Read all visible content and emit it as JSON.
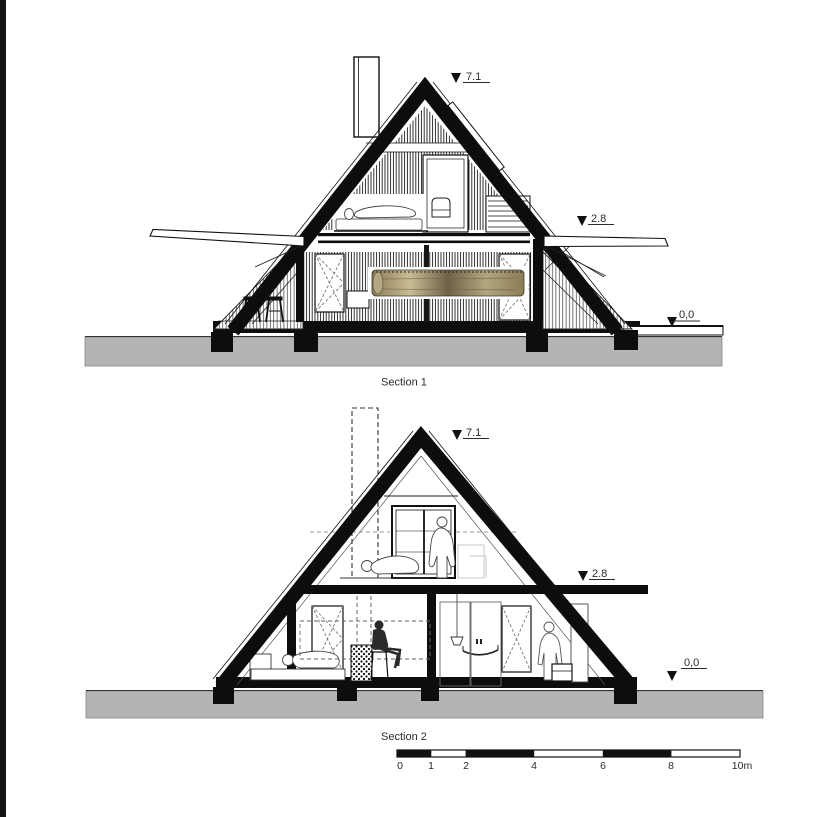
{
  "page": {
    "background": "#ffffff"
  },
  "colors": {
    "ink": "#111111",
    "left_bar": "#141414",
    "ground": "#b4b4b4",
    "wood_dark": "#6f6147",
    "wood_light": "#cfc3a0"
  },
  "section1": {
    "label": "Section 1",
    "elevations": {
      "ridge": "7.1",
      "upper_floor": "2.8",
      "ground": "0,0"
    }
  },
  "section2": {
    "label": "Section 2",
    "elevations": {
      "ridge": "7.1",
      "upper_floor": "2.8",
      "ground": "0,0"
    }
  },
  "scale_bar": {
    "ticks": [
      "0",
      "1",
      "2",
      "4",
      "6",
      "8",
      "10m"
    ]
  }
}
